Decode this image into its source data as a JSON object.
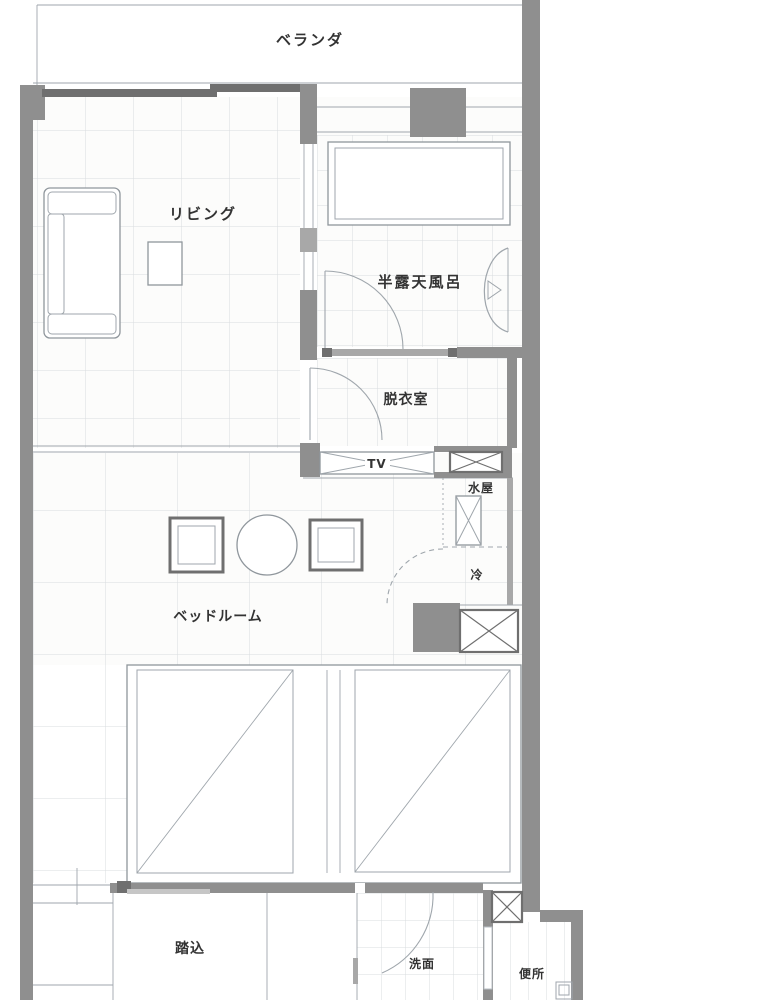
{
  "plan_title": "guest-room floor plan",
  "colors": {
    "wall": "#8f8f8f",
    "wallmid": "#a8a8a8",
    "walldark": "#6f6f6f",
    "line": "#9fa6ac",
    "grid": "#d9dcdf",
    "room": "#fcfcfb",
    "furn": "#8f969c",
    "text": "#333333"
  },
  "rooms": {
    "balcony": {
      "label": "ベランダ"
    },
    "living": {
      "label": "リビング"
    },
    "bath": {
      "label": "半露天風呂"
    },
    "dressing": {
      "label": "脱衣室"
    },
    "bedroom": {
      "label": "ベッドルーム"
    },
    "entrance": {
      "label": "踏込"
    },
    "washroom": {
      "label": "洗面"
    },
    "toilet": {
      "label": "便所"
    },
    "kitchenette": {
      "label": "水屋"
    },
    "fridge": {
      "label": "冷"
    },
    "tv": {
      "label": "TV"
    }
  }
}
